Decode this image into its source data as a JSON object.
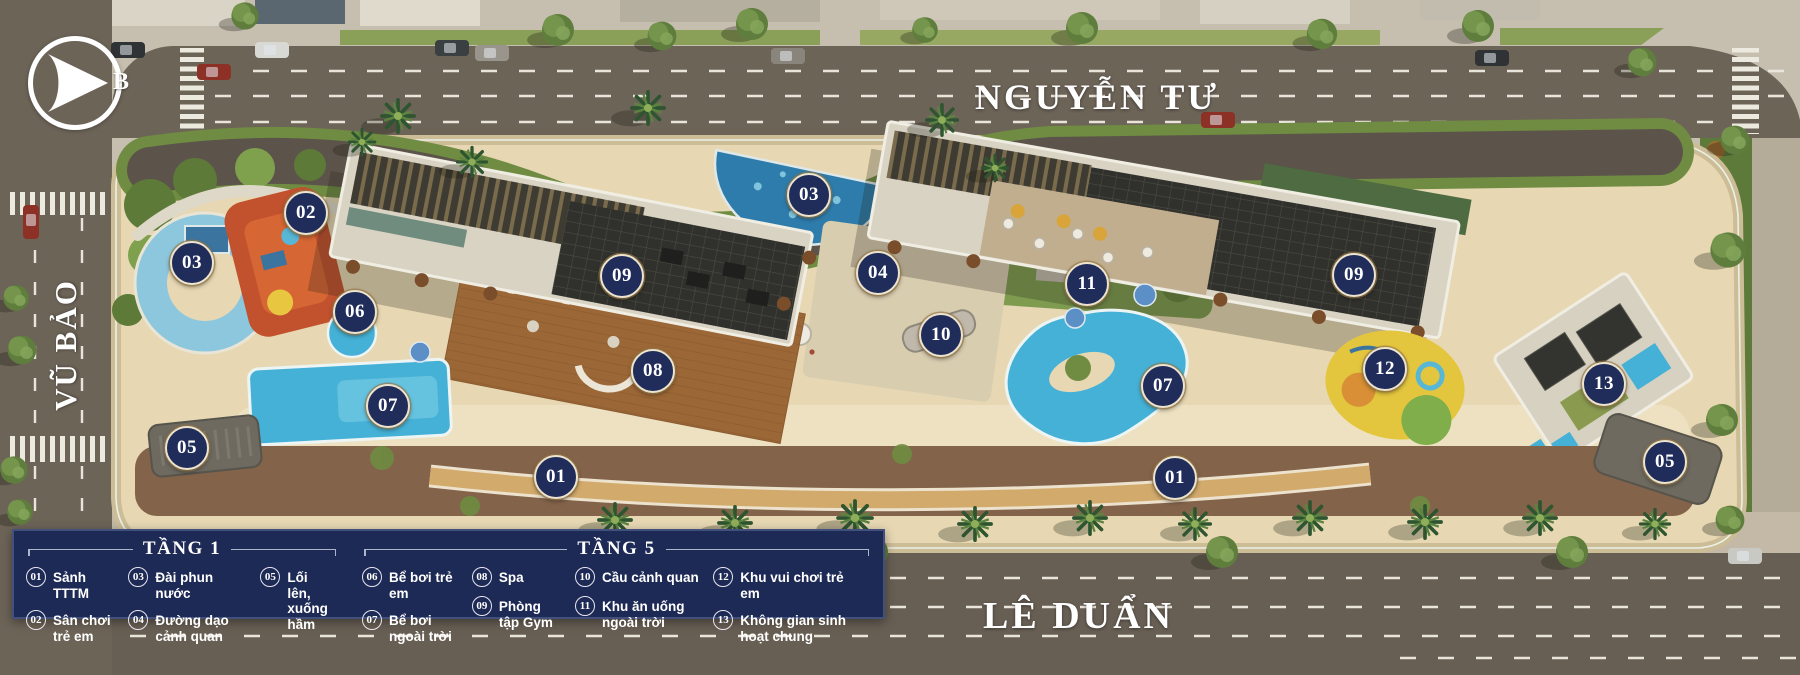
{
  "compass": {
    "north_label": "B"
  },
  "streets": {
    "top": "NGUYỄN TƯ",
    "left": "VŨ BẢO",
    "bottom": "LÊ DUẨN"
  },
  "colors": {
    "marker_bg": "#202c5a",
    "marker_border": "#ece4cf",
    "legend_bg": "#1e2a56",
    "legend_text": "#ffffff",
    "road": "#6d6458",
    "sand": "#e7d8b3",
    "pool": "#45b1d6",
    "deck": "#9c6736",
    "roof": "#30302c",
    "green": "#6f8c42"
  },
  "plan": {
    "markers": [
      {
        "num": "02",
        "x": 304,
        "y": 211
      },
      {
        "num": "03",
        "x": 190,
        "y": 261
      },
      {
        "num": "03",
        "x": 807,
        "y": 193
      },
      {
        "num": "09",
        "x": 620,
        "y": 274
      },
      {
        "num": "04",
        "x": 876,
        "y": 271
      },
      {
        "num": "06",
        "x": 353,
        "y": 310
      },
      {
        "num": "11",
        "x": 1085,
        "y": 282
      },
      {
        "num": "09",
        "x": 1352,
        "y": 273
      },
      {
        "num": "10",
        "x": 939,
        "y": 333
      },
      {
        "num": "08",
        "x": 651,
        "y": 369
      },
      {
        "num": "12",
        "x": 1383,
        "y": 367
      },
      {
        "num": "13",
        "x": 1602,
        "y": 382
      },
      {
        "num": "07",
        "x": 386,
        "y": 404
      },
      {
        "num": "07",
        "x": 1161,
        "y": 384
      },
      {
        "num": "05",
        "x": 185,
        "y": 446
      },
      {
        "num": "05",
        "x": 1663,
        "y": 460
      },
      {
        "num": "01",
        "x": 554,
        "y": 475
      },
      {
        "num": "01",
        "x": 1173,
        "y": 476
      }
    ]
  },
  "legend": {
    "floors": [
      {
        "title": "TẦNG 1",
        "items": [
          {
            "num": "01",
            "label": "Sảnh TTTM"
          },
          {
            "num": "02",
            "label": "Sân chơi trẻ em"
          },
          {
            "num": "03",
            "label": "Đài phun nước"
          },
          {
            "num": "04",
            "label": "Đường dạo cảnh quan"
          },
          {
            "num": "05",
            "label": "Lối lên,\nxuống hầm"
          }
        ]
      },
      {
        "title": "TẦNG 5",
        "items": [
          {
            "num": "06",
            "label": "Bể bơi trẻ em"
          },
          {
            "num": "07",
            "label": "Bể bơi ngoài trời"
          },
          {
            "num": "08",
            "label": "Spa"
          },
          {
            "num": "09",
            "label": "Phòng tập Gym"
          },
          {
            "num": "10",
            "label": "Cầu cảnh quan"
          },
          {
            "num": "11",
            "label": "Khu ăn uống ngoài trời"
          },
          {
            "num": "12",
            "label": "Khu vui chơi trẻ em"
          },
          {
            "num": "13",
            "label": "Không gian sinh hoạt chung"
          }
        ]
      }
    ]
  }
}
